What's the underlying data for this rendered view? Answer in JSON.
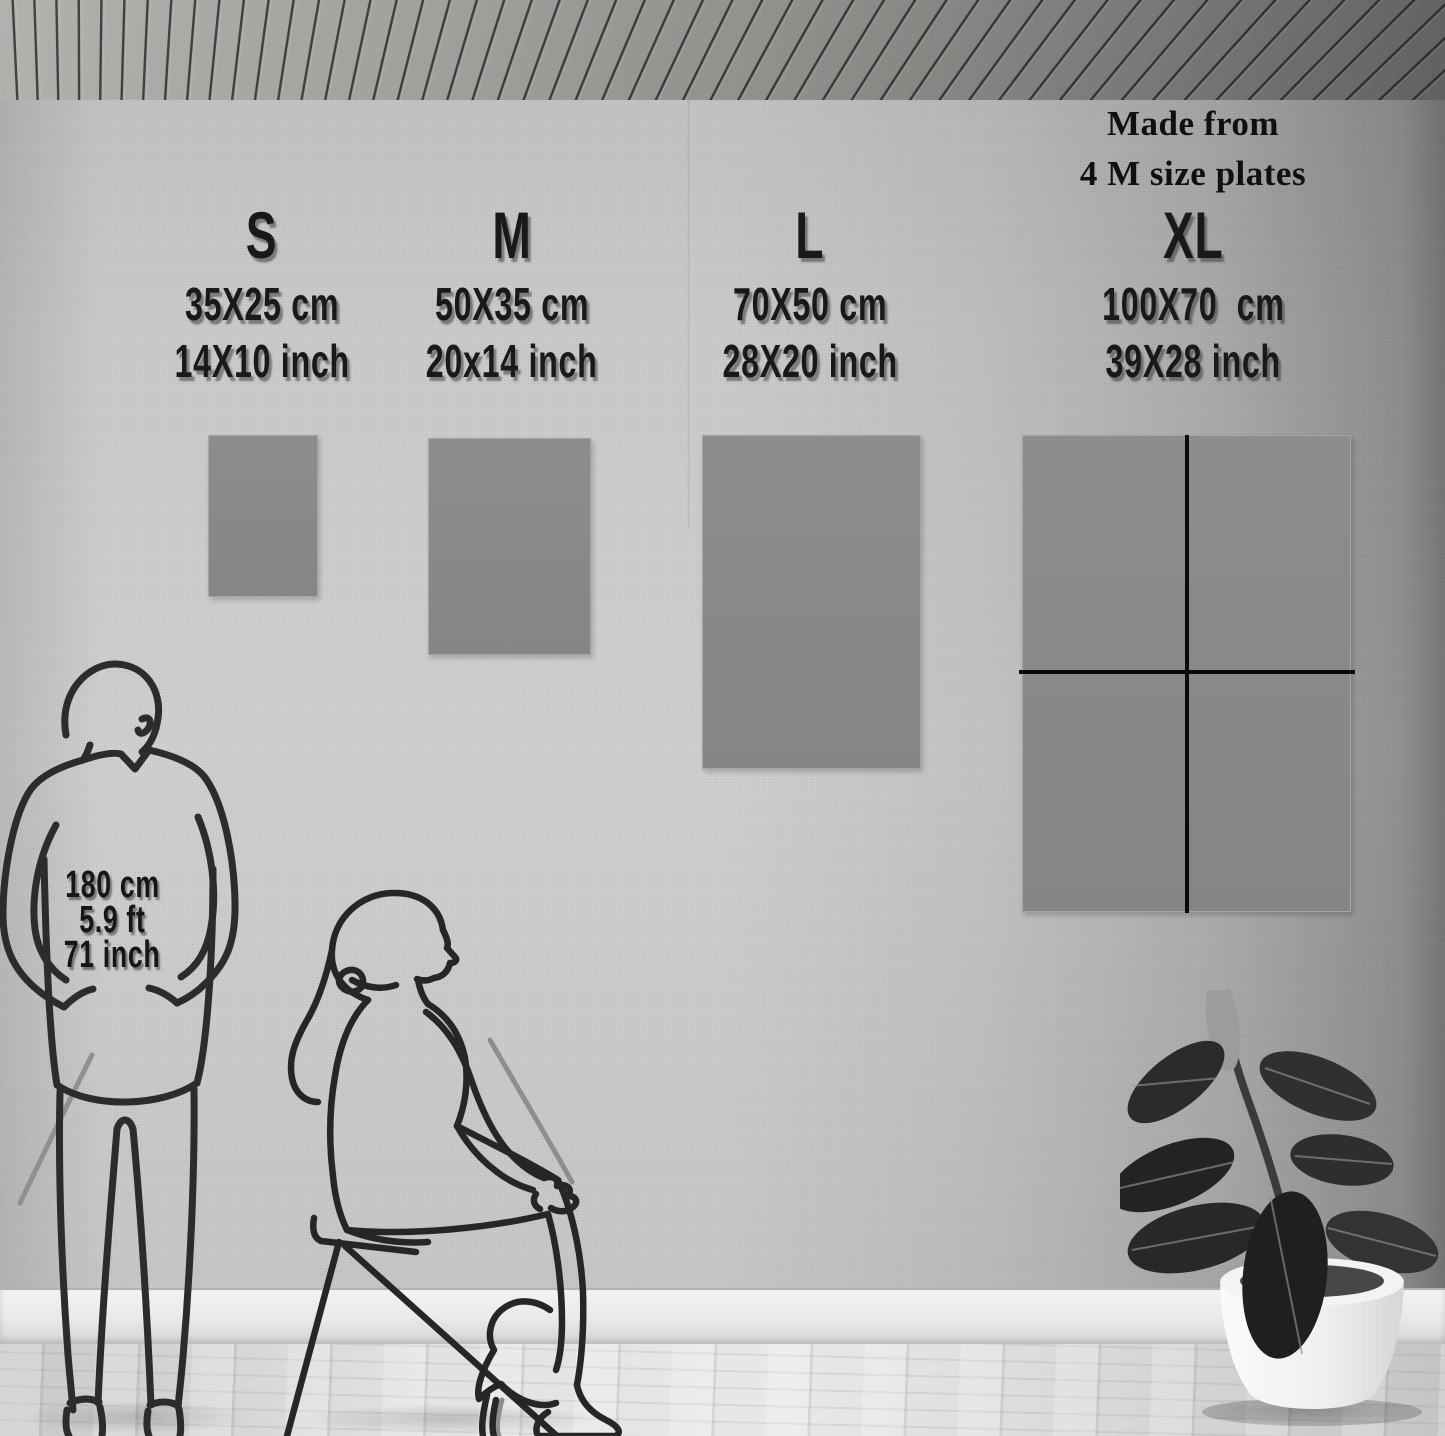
{
  "note": {
    "line1": "Made from",
    "line2": "4 M size plates"
  },
  "sizes": [
    {
      "label": "S",
      "cm": "35X25 cm",
      "inch": "14X10 inch"
    },
    {
      "label": "M",
      "cm": "50X35 cm",
      "inch": "20x14 inch"
    },
    {
      "label": "L",
      "cm": "70X50 cm",
      "inch": "28X20 inch"
    },
    {
      "label": "XL",
      "cm": "100X70  cm",
      "inch": "39X28 inch"
    }
  ],
  "person": {
    "cm": "180 cm",
    "ft": "5.9 ft",
    "inch": "71 inch"
  },
  "colors": {
    "plate": "#8a8a8a",
    "text": "#1a1a1a",
    "divider": "#0b0b0b",
    "wall": "#cbcbcb"
  }
}
